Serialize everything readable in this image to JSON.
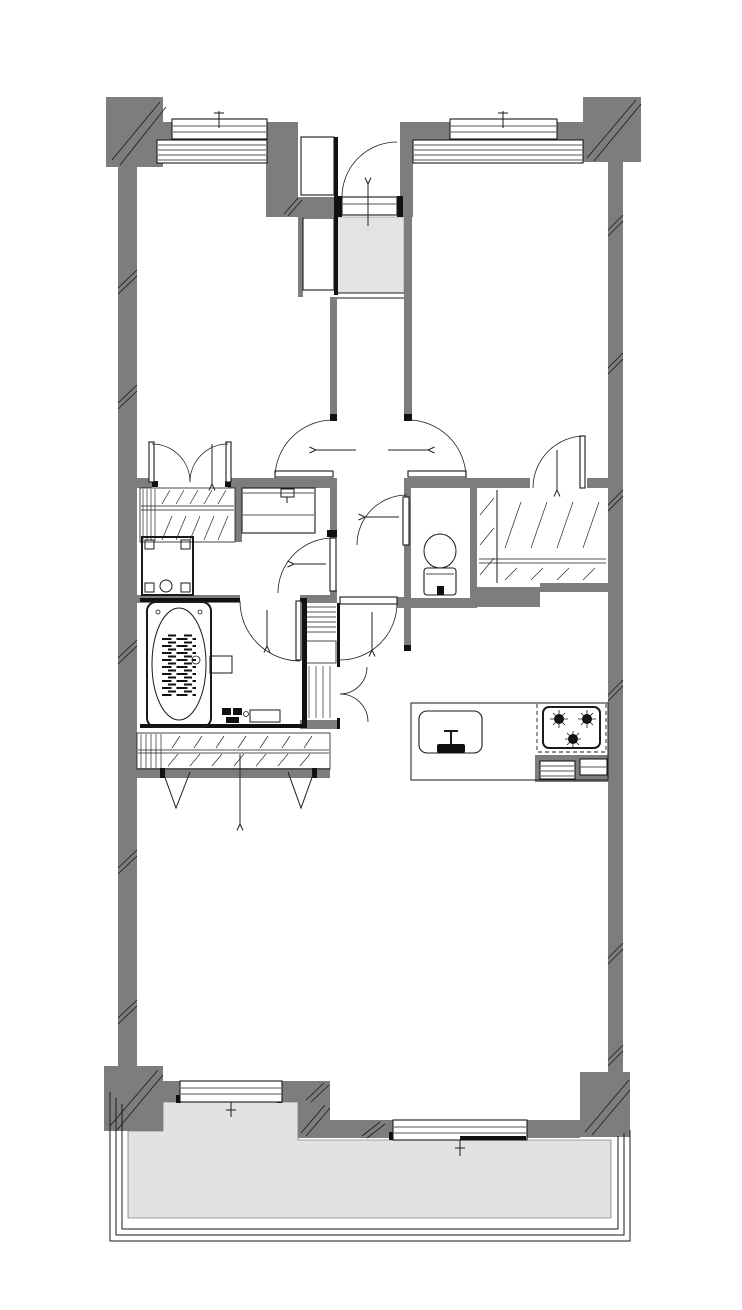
{
  "page": {
    "title": "apartment-floor-plan",
    "type": "architectural-floor-plan",
    "width_px": 742,
    "height_px": 1310
  },
  "colors": {
    "paper": "#ffffff",
    "wall": "#7d7d7d",
    "entry_tile": "#e3e3e3",
    "balcony_floor": "#e2e2e2",
    "line": "#1a1a1a"
  },
  "rooms": [
    "entrance-hall",
    "corridor",
    "bedroom-upper-left",
    "bedroom-upper-right",
    "washroom",
    "bathroom",
    "toilet-room",
    "closet-upper-left",
    "closet-upper-right",
    "living-dining-kitchen",
    "balcony"
  ],
  "fixtures": [
    "entrance-swing-door",
    "shoe-cabinet",
    "entry-tile-floor",
    "step-edge",
    "double-closet-doors",
    "hanging-rod",
    "shelf-hatching",
    "washbasin-vanity",
    "washing-machine-pan",
    "bathtub",
    "bath-counter-faucet",
    "toilet-with-tank",
    "linen-shelf-column",
    "storage-double-doors",
    "bifold-closet-doors",
    "kitchen-counter",
    "kitchen-sink",
    "sink-faucet",
    "gas-stove-3-burner",
    "kitchen-base-cabinets",
    "sliding-window-top-left",
    "sliding-window-top-right",
    "window-bench-louvers-left",
    "window-bench-louvers-right",
    "balcony-sliding-door-left",
    "balcony-sliding-door-right",
    "balcony-railing",
    "concrete-columns",
    "wall-hatch-ticks",
    "swing-direction-arrows"
  ],
  "doors": [
    "entrance-swing-door",
    "bedroom-left-door",
    "bedroom-right-door",
    "closet-right-door",
    "toilet-door",
    "washroom-door",
    "bathroom-door",
    "ldk-door",
    "closet-left-double-doors",
    "storage-double-doors",
    "bifold-closet-doors"
  ],
  "windows": [
    "top-left-sliding-window",
    "top-right-sliding-window",
    "balcony-left-sliding-door",
    "balcony-right-sliding-door"
  ]
}
